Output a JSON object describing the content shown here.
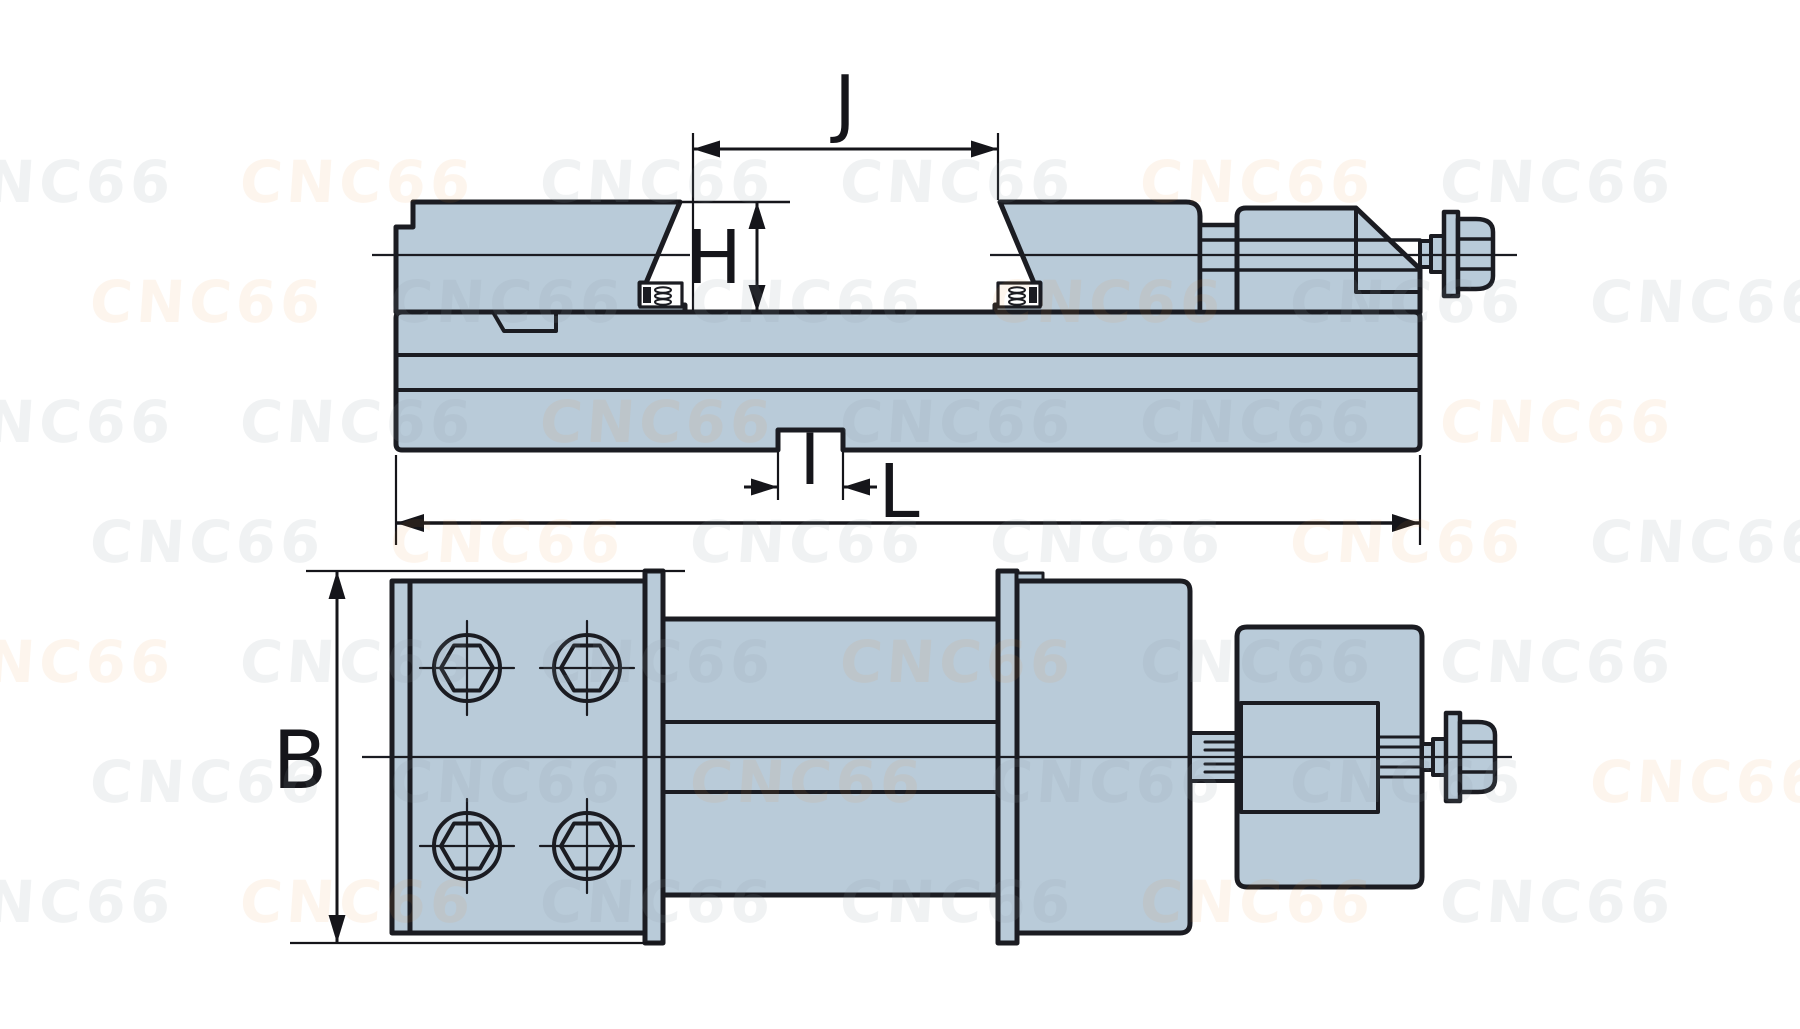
{
  "drawing": {
    "title": "machine vise technical drawing - side elevation and plan view",
    "labels": {
      "J": "J",
      "H": "H",
      "I": "I",
      "L": "L",
      "B": "B"
    },
    "colors": {
      "part_fill": "#b9cbd9",
      "outline": "#1b1c22",
      "dimension": "#15151a",
      "background": "#ffffff"
    }
  },
  "watermark": {
    "text": "CNC66",
    "gray": "rgba(139,152,166,0.13)",
    "orange": "rgba(233,148,58,0.09)",
    "font_size": 58,
    "rows": 7,
    "cols": 6,
    "step_x": 300,
    "step_y": 120,
    "row_offset": 150,
    "start_x": -60,
    "start_y": 148
  }
}
